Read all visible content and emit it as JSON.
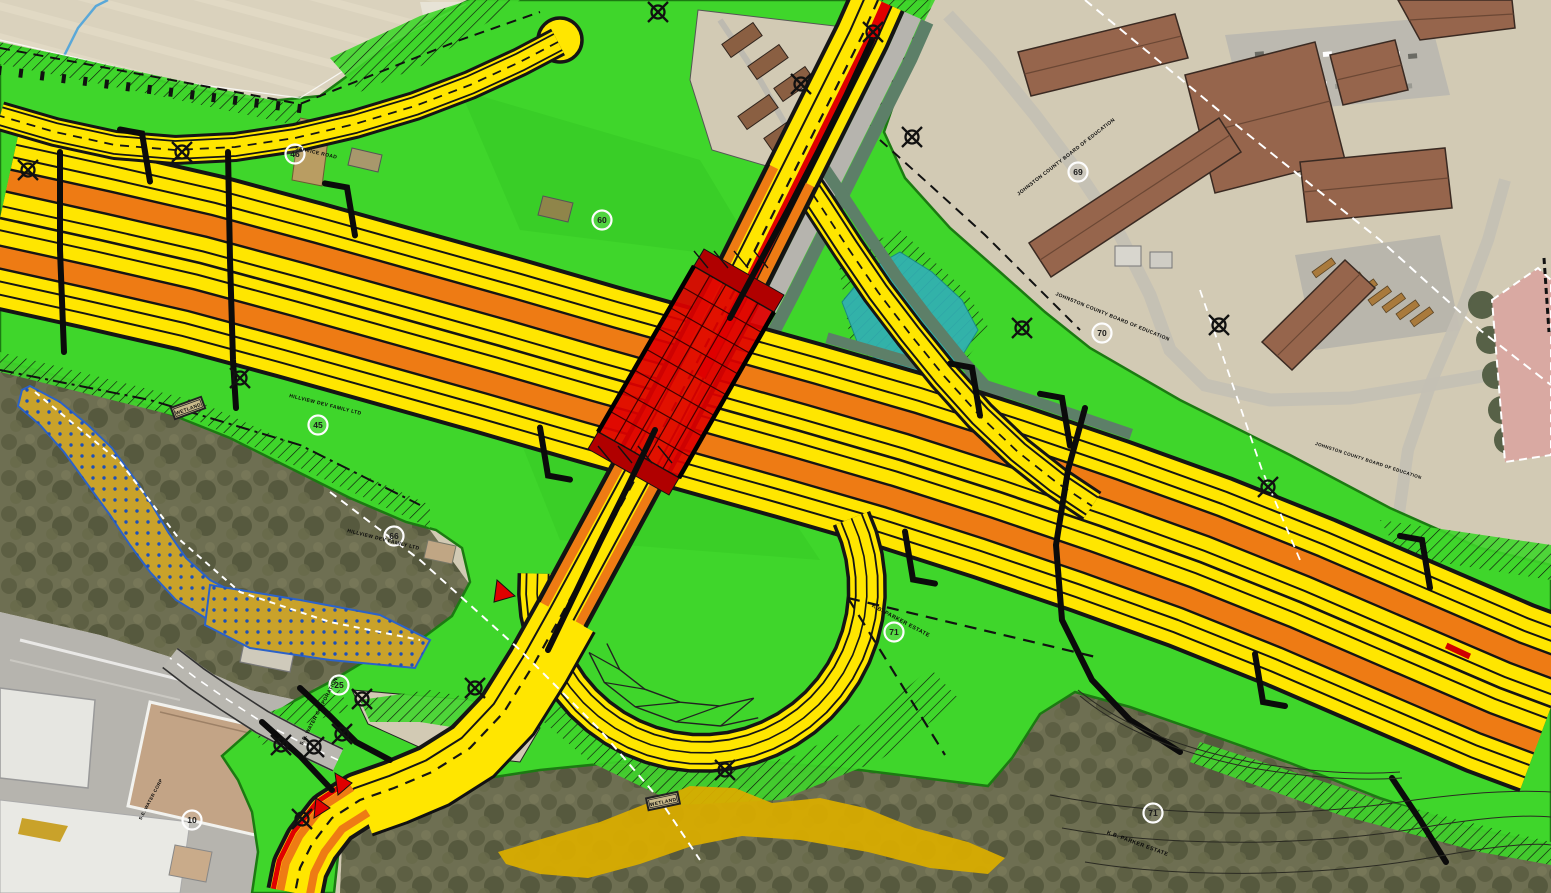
{
  "map": {
    "type": "roadway-construction-plan-over-aerial",
    "palette": {
      "green": "#3fd62b",
      "green_dark": "#1c7a12",
      "yellow": "#ffe600",
      "orange": "#ee7b14",
      "red": "#e00000",
      "teal": "#31b0b4",
      "wetland_gold": "#c9a22a",
      "marsh_gold": "#d8ac00",
      "aerial_tan": "#d2cab4",
      "field_tan": "#dad2bd",
      "woods": "#6e6f52",
      "asphalt": "#b6b4ae",
      "roof_brown": "#96654c",
      "roof_pink": "#d9a9a2",
      "slate": "#5d7f68",
      "wet_dot_blue": "#1d50b8",
      "line_black": "#0b0b0b",
      "line_white": "#ffffff"
    },
    "labels": {
      "owners": [
        {
          "text": "JOHNSTON COUNTY BOARD OF EDUCATION",
          "x": 1067,
          "y": 158,
          "rot": -38,
          "size": 5
        },
        {
          "text": "JOHNSTON COUNTY BOARD OF EDUCATION",
          "x": 1112,
          "y": 318,
          "rot": 22,
          "size": 5
        },
        {
          "text": "JOHNSTON COUNTY BOARD OF EDUCATION",
          "x": 1368,
          "y": 462,
          "rot": 18,
          "size": 4.5
        },
        {
          "text": "HILLVIEW DEV FAMILY LTD",
          "x": 325,
          "y": 406,
          "rot": 14,
          "size": 5
        },
        {
          "text": "HILLVIEW DEV FAMILY LTD",
          "x": 383,
          "y": 541,
          "rot": 14,
          "size": 5
        },
        {
          "text": "K.B. PARKER ESTATE",
          "x": 900,
          "y": 622,
          "rot": 28,
          "size": 5.5
        },
        {
          "text": "K.B. PARKER ESTATE",
          "x": 1137,
          "y": 845,
          "rot": 20,
          "size": 5.5
        },
        {
          "text": "S.E. WATER CORPORATION",
          "x": 320,
          "y": 712,
          "rot": -62,
          "size": 5
        },
        {
          "text": "S.E. WATER CORP",
          "x": 152,
          "y": 800,
          "rot": -62,
          "size": 4.5
        }
      ],
      "roads": [
        {
          "text": "SERVICE ROAD",
          "x": 316,
          "y": 154,
          "rot": 13,
          "size": 5
        }
      ],
      "stamps": [
        {
          "text": "WETLAND",
          "x": 188,
          "y": 408,
          "rot": -20
        },
        {
          "text": "WETLAND",
          "x": 663,
          "y": 801,
          "rot": -12
        }
      ],
      "parcels": [
        {
          "num": "46",
          "x": 295,
          "y": 154
        },
        {
          "num": "60",
          "x": 602,
          "y": 220
        },
        {
          "num": "45",
          "x": 318,
          "y": 425
        },
        {
          "num": "66",
          "x": 394,
          "y": 536
        },
        {
          "num": "69",
          "x": 1078,
          "y": 172
        },
        {
          "num": "70",
          "x": 1102,
          "y": 333
        },
        {
          "num": "71",
          "x": 894,
          "y": 632
        },
        {
          "num": "71",
          "x": 1153,
          "y": 813
        },
        {
          "num": "25",
          "x": 339,
          "y": 685
        },
        {
          "num": "10",
          "x": 192,
          "y": 820
        }
      ]
    },
    "symbols": {
      "utility_pole_icon": "circle-with-x-spokes",
      "parcel_bubble_icon": "white-circle-number",
      "poles": [
        [
          28,
          170
        ],
        [
          182,
          152
        ],
        [
          658,
          12
        ],
        [
          873,
          32
        ],
        [
          801,
          84
        ],
        [
          912,
          137
        ],
        [
          1022,
          328
        ],
        [
          1219,
          325
        ],
        [
          1268,
          487
        ],
        [
          725,
          770
        ],
        [
          362,
          699
        ],
        [
          342,
          734
        ],
        [
          314,
          747
        ],
        [
          281,
          745
        ],
        [
          302,
          819
        ],
        [
          475,
          688
        ],
        [
          240,
          378
        ]
      ]
    }
  }
}
